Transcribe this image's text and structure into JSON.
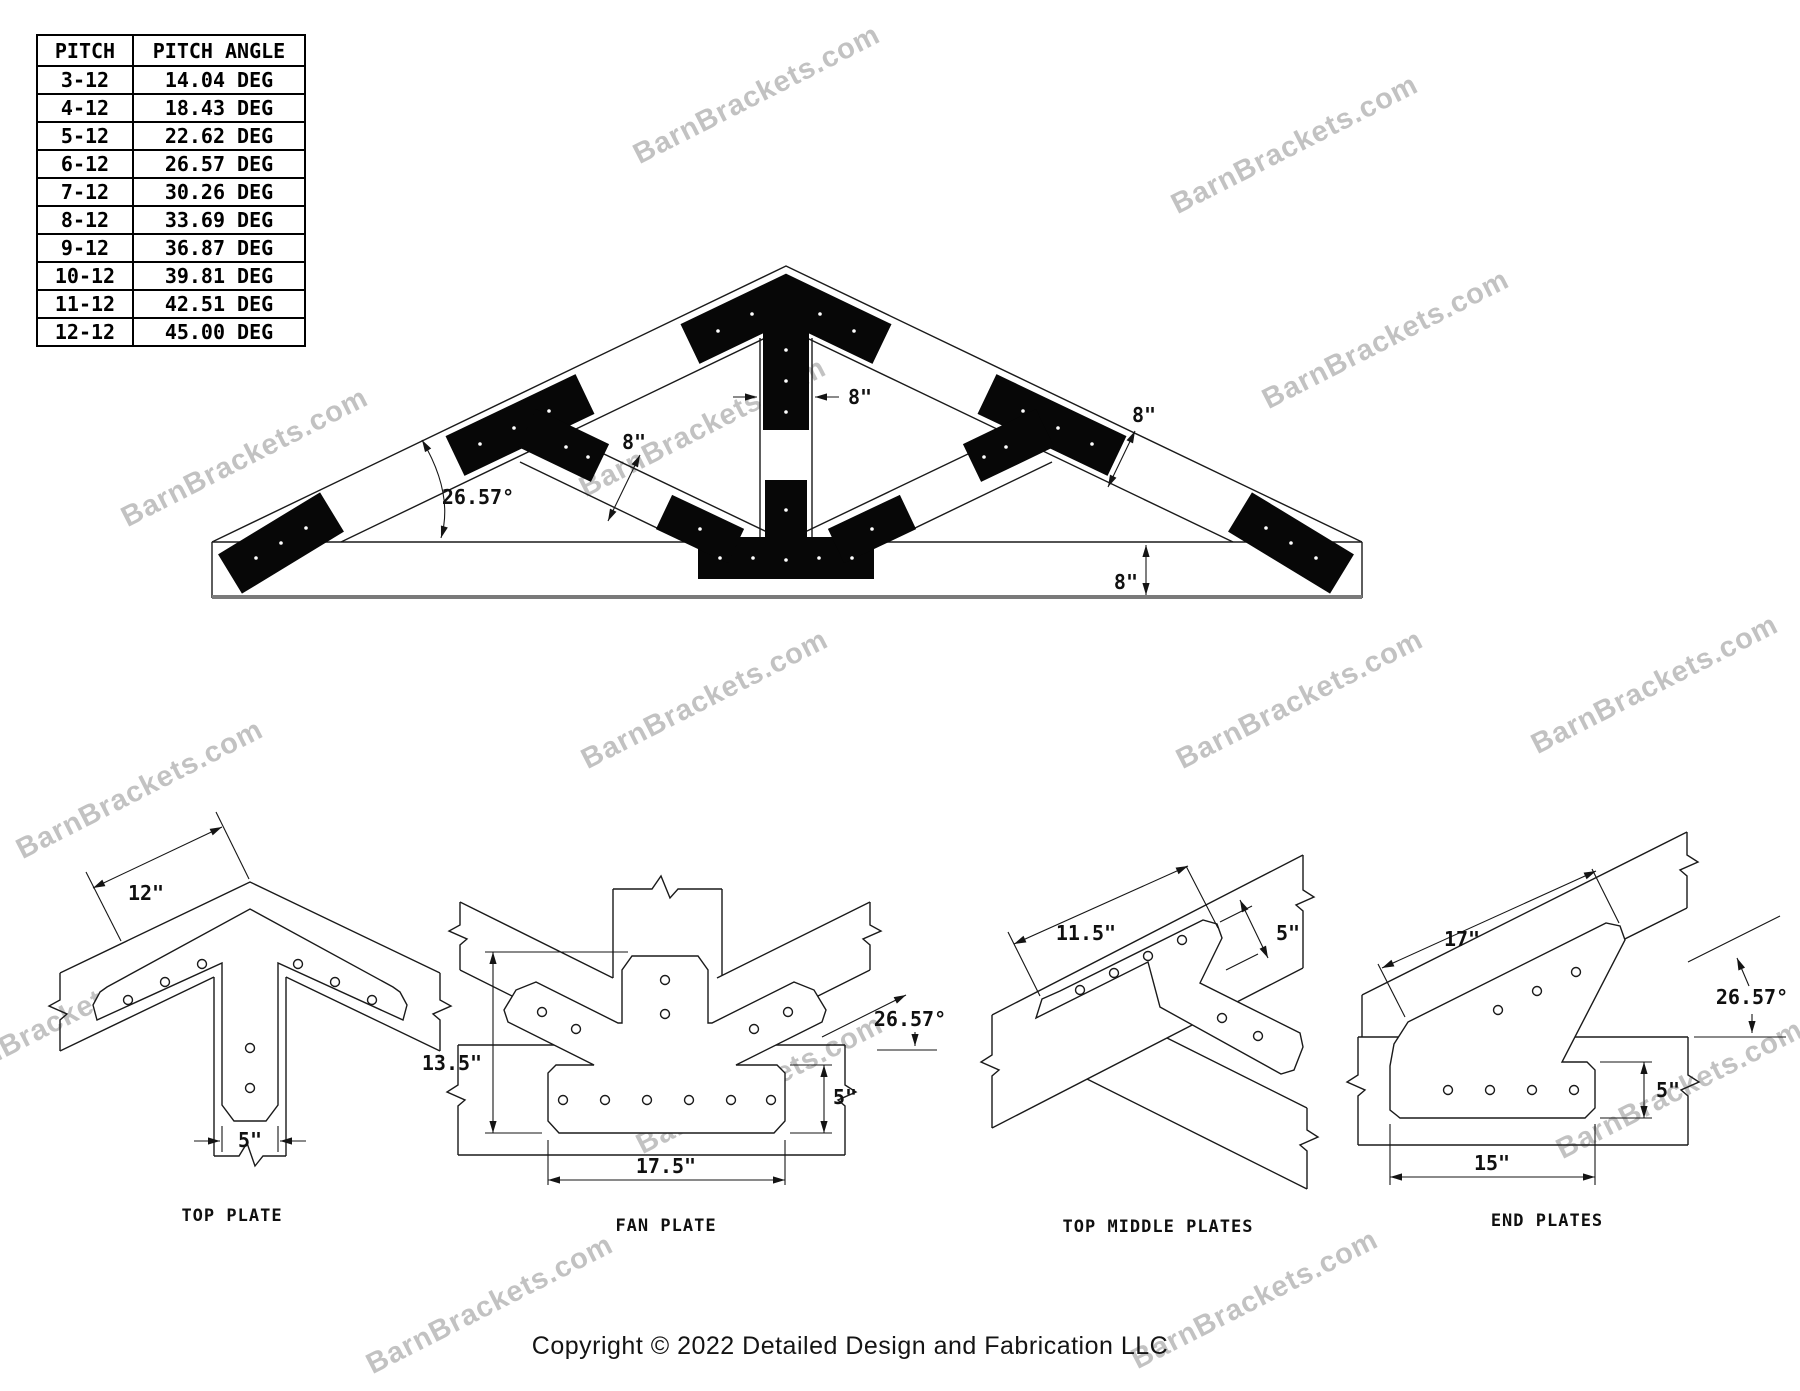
{
  "watermark": {
    "text": "BarnBrackets.com"
  },
  "pitch_table": {
    "header": {
      "pitch": "PITCH",
      "angle": "PITCH ANGLE"
    },
    "rows": [
      {
        "pitch": "3-12",
        "angle": "14.04 DEG"
      },
      {
        "pitch": "4-12",
        "angle": "18.43 DEG"
      },
      {
        "pitch": "5-12",
        "angle": "22.62 DEG"
      },
      {
        "pitch": "6-12",
        "angle": "26.57 DEG"
      },
      {
        "pitch": "7-12",
        "angle": "30.26 DEG"
      },
      {
        "pitch": "8-12",
        "angle": "33.69 DEG"
      },
      {
        "pitch": "9-12",
        "angle": "36.87 DEG"
      },
      {
        "pitch": "10-12",
        "angle": "39.81 DEG"
      },
      {
        "pitch": "11-12",
        "angle": "42.51 DEG"
      },
      {
        "pitch": "12-12",
        "angle": "45.00 DEG"
      }
    ]
  },
  "truss": {
    "dims": {
      "king_post_width": "8\"",
      "strut_width": "8\"",
      "rafter_width": "8\"",
      "chord_width": "8\"",
      "pitch_angle": "26.57°"
    }
  },
  "details": {
    "top_plate": {
      "label": "TOP PLATE",
      "dims": {
        "arm_length": "12\"",
        "stem_width": "5\""
      }
    },
    "fan_plate": {
      "label": "FAN PLATE",
      "dims": {
        "height": "13.5\"",
        "base_length": "17.5\"",
        "base_height": "5\"",
        "strut_angle": "26.57°"
      }
    },
    "top_middle_plates": {
      "label": "TOP MIDDLE PLATES",
      "dims": {
        "length": "11.5\"",
        "width": "5\""
      }
    },
    "end_plates": {
      "label": "END PLATES",
      "dims": {
        "rafter_length": "17\"",
        "angle": "26.57°",
        "base_height": "5\"",
        "base_length": "15\""
      }
    }
  },
  "footer": {
    "copyright": "Copyright © 2022 Detailed Design and Fabrication LLC"
  }
}
